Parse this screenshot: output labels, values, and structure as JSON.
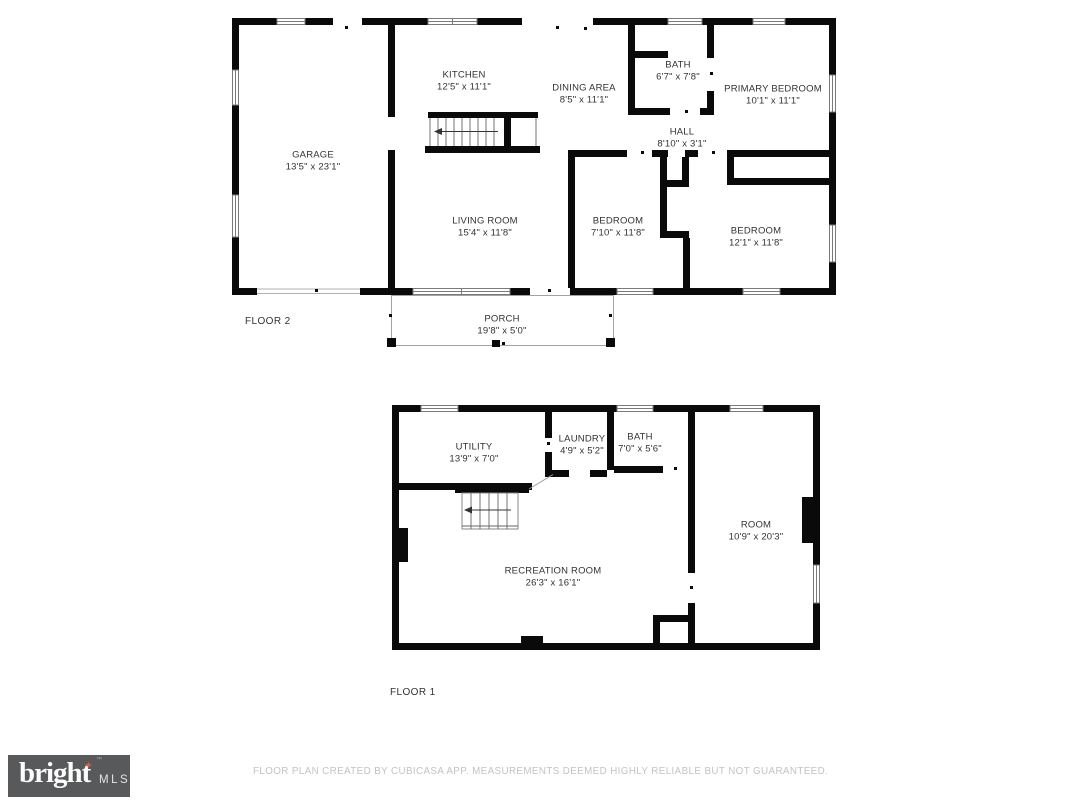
{
  "colors": {
    "wall": "#0a0a0a",
    "label_text": "#323232",
    "logo_box": "#58595b",
    "logo_star": "#d85a3e",
    "disclaimer_text": "#c3c3c3"
  },
  "floor2": {
    "label": "FLOOR 2",
    "rooms": [
      {
        "name": "KITCHEN",
        "dims": "12'5\" x 11'1\""
      },
      {
        "name": "DINING AREA",
        "dims": "8'5\" x 11'1\""
      },
      {
        "name": "BATH",
        "dims": "6'7\" x 7'8\""
      },
      {
        "name": "PRIMARY BEDROOM",
        "dims": "10'1\" x 11'1\""
      },
      {
        "name": "HALL",
        "dims": "8'10\" x 3'1\""
      },
      {
        "name": "GARAGE",
        "dims": "13'5\" x 23'1\""
      },
      {
        "name": "LIVING ROOM",
        "dims": "15'4\" x 11'8\""
      },
      {
        "name": "BEDROOM",
        "dims": "7'10\" x 11'8\""
      },
      {
        "name": "BEDROOM",
        "dims": "12'1\" x 11'8\""
      },
      {
        "name": "PORCH",
        "dims": "19'8\" x 5'0\""
      }
    ]
  },
  "floor1": {
    "label": "FLOOR 1",
    "rooms": [
      {
        "name": "UTILITY",
        "dims": "13'9\" x 7'0\""
      },
      {
        "name": "LAUNDRY",
        "dims": "4'9\" x 5'2\""
      },
      {
        "name": "BATH",
        "dims": "7'0\" x 5'6\""
      },
      {
        "name": "ROOM",
        "dims": "10'9\" x 20'3\""
      },
      {
        "name": "RECREATION ROOM",
        "dims": "26'3\" x 16'1\""
      }
    ]
  },
  "footer": {
    "logo": {
      "brand": "bright",
      "suffix": "MLS",
      "star": "✦",
      "tm": "™"
    },
    "disclaimer": "FLOOR PLAN CREATED BY CUBICASA APP. MEASUREMENTS DEEMED HIGHLY RELIABLE BUT NOT GUARANTEED."
  }
}
